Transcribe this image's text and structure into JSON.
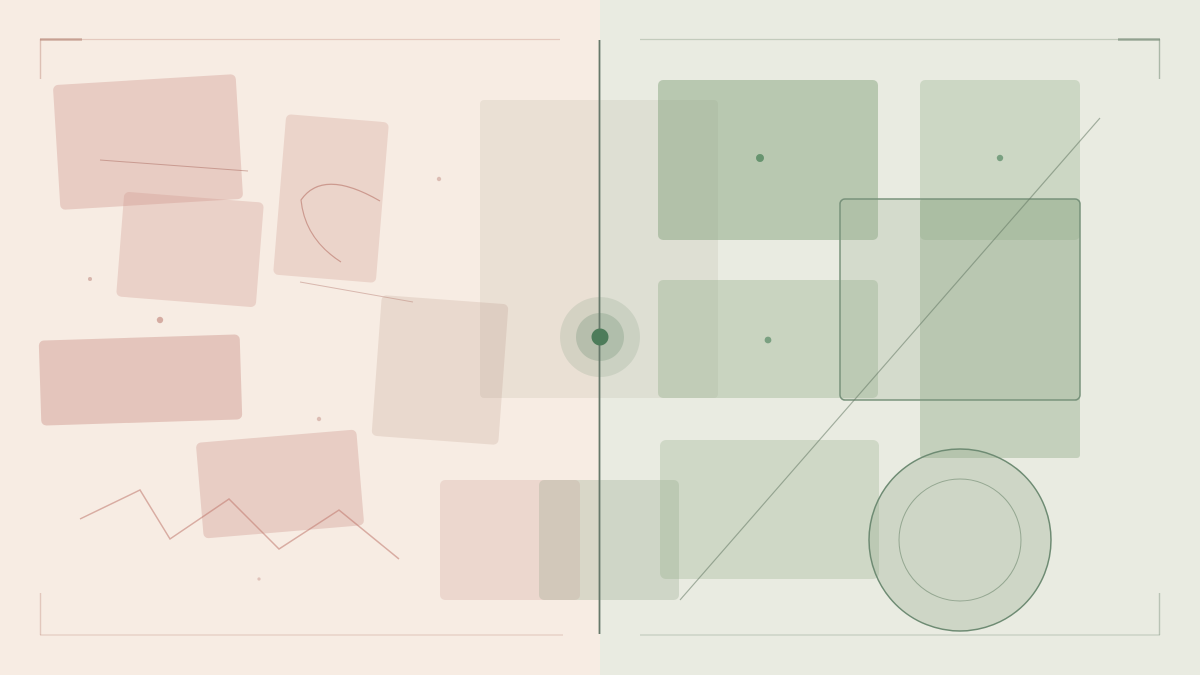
{
  "canvas": {
    "viewBox": "0 0 1200 675",
    "width": 1200,
    "height": 675,
    "split_x": 600,
    "left_background": "#f7ece3",
    "right_background": "#e9ebe1"
  },
  "palette": {
    "blush_fill": "rgba(206,148,138,0.36)",
    "blush_line": "rgba(170,105,95,0.5)",
    "sage_fill": "rgba(135,165,125,0.32)",
    "sage_outline": "#78927b",
    "divider": "#66786a",
    "bullseye_dot": "#4d7c5a"
  },
  "shapes": [
    {
      "type": "rect",
      "name": "background-left-panel",
      "x": 0,
      "y": 0,
      "w": 600,
      "h": 675,
      "fill": "#f7ece3"
    },
    {
      "type": "rect",
      "name": "background-right-panel",
      "x": 600,
      "y": 0,
      "w": 600,
      "h": 675,
      "fill": "#e9ebe1"
    },
    {
      "type": "rect",
      "name": "pink-rect-top-left",
      "x": 56.5,
      "y": 79.5,
      "w": 183,
      "h": 125,
      "rx": 5,
      "rot": -3.5,
      "fill": "rgba(206,148,138,0.36)"
    },
    {
      "type": "rect",
      "name": "pink-rect-mid-left",
      "x": 120,
      "y": 197,
      "w": 140,
      "h": 105,
      "rx": 5,
      "rot": 4.5,
      "fill": "rgba(208,152,142,0.32)"
    },
    {
      "type": "rect",
      "name": "pink-rect-arc-card",
      "x": 279.5,
      "y": 118,
      "w": 103,
      "h": 161,
      "rx": 5,
      "rot": 4.7,
      "fill": "rgba(208,155,145,0.30)"
    },
    {
      "type": "line",
      "name": "thin-line-upper",
      "x1": 100,
      "y1": 160,
      "x2": 248,
      "y2": 171,
      "stroke": "rgba(170,105,95,0.5)",
      "sw": 1
    },
    {
      "type": "path",
      "name": "arc-motif",
      "d": "M 380,201 Q 323,168 301,200 Q 305,239 341,262",
      "fill": "none",
      "stroke": "rgba(178,106,94,0.55)",
      "sw": 1.2
    },
    {
      "type": "line",
      "name": "thin-line-lower",
      "x1": 300,
      "y1": 282,
      "x2": 413,
      "y2": 302,
      "stroke": "rgba(170,105,95,0.4)",
      "sw": 1
    },
    {
      "type": "rect",
      "name": "pink-rect-wide-left",
      "x": 40,
      "y": 337.5,
      "w": 201,
      "h": 85,
      "rx": 5,
      "rot": -1.8,
      "fill": "rgba(200,140,130,0.40)"
    },
    {
      "type": "rect",
      "name": "pale-tilted-rect",
      "x": 376.5,
      "y": 299.5,
      "w": 127,
      "h": 141,
      "rx": 5,
      "rot": 4.2,
      "fill": "rgba(185,150,132,0.22)"
    },
    {
      "type": "rect",
      "name": "pink-rect-bottom",
      "x": 199.5,
      "y": 436,
      "w": 161,
      "h": 96,
      "rx": 5,
      "rot": -4.8,
      "fill": "rgba(203,148,138,0.34)"
    },
    {
      "type": "polyline",
      "name": "zigzag-line",
      "points": "80,519 140,490 170,539 229,499 279,549 339,510 399,559",
      "fill": "none",
      "stroke": "rgba(192,120,110,0.55)",
      "sw": 1.5
    },
    {
      "type": "circle",
      "name": "pink-dot-1",
      "cx": 90,
      "cy": 279,
      "r": 2,
      "fill": "rgba(175,115,105,0.45)"
    },
    {
      "type": "circle",
      "name": "pink-dot-2",
      "cx": 160,
      "cy": 320,
      "r": 3.2,
      "fill": "rgba(185,120,110,0.55)"
    },
    {
      "type": "circle",
      "name": "pink-dot-3",
      "cx": 439,
      "cy": 179,
      "r": 2.2,
      "fill": "rgba(180,120,110,0.4)"
    },
    {
      "type": "circle",
      "name": "pink-dot-4",
      "cx": 319,
      "cy": 419,
      "r": 2.2,
      "fill": "rgba(180,120,110,0.4)"
    },
    {
      "type": "circle",
      "name": "pink-dot-5",
      "cx": 259,
      "cy": 579,
      "r": 1.6,
      "fill": "rgba(180,120,110,0.35)"
    },
    {
      "type": "rect",
      "name": "pale-center-rect",
      "x": 480,
      "y": 100,
      "w": 238,
      "h": 298,
      "rx": 4,
      "fill": "rgba(125,115,92,0.10)"
    },
    {
      "type": "rect",
      "name": "straddle-pink-rect",
      "x": 440,
      "y": 480,
      "w": 140,
      "h": 120,
      "rx": 5,
      "fill": "rgba(208,160,150,0.28)"
    },
    {
      "type": "rect",
      "name": "straddle-green-rect",
      "x": 539,
      "y": 480,
      "w": 140,
      "h": 120,
      "rx": 5,
      "fill": "rgba(148,165,138,0.30)"
    },
    {
      "type": "rect",
      "name": "green-rect-top-left",
      "x": 658,
      "y": 80,
      "w": 220,
      "h": 160,
      "rx": 5,
      "fill": "rgba(125,158,118,0.45)"
    },
    {
      "type": "rect",
      "name": "green-rect-top-right",
      "x": 920,
      "y": 80,
      "w": 160,
      "h": 160,
      "rx": 5,
      "fill": "rgba(138,168,130,0.30)"
    },
    {
      "type": "rect",
      "name": "green-rect-tall",
      "x": 920,
      "y": 199,
      "w": 160,
      "h": 259,
      "rx": 3,
      "fill": "rgba(138,165,128,0.38)"
    },
    {
      "type": "rect",
      "name": "green-rect-middle",
      "x": 658,
      "y": 280,
      "w": 220,
      "h": 118,
      "rx": 5,
      "fill": "rgba(135,165,125,0.32)"
    },
    {
      "type": "rect",
      "name": "green-rect-bottom",
      "x": 660,
      "y": 440,
      "w": 219,
      "h": 139,
      "rx": 6,
      "fill": "rgba(140,168,130,0.28)"
    },
    {
      "type": "rect",
      "name": "outlined-green-rect",
      "x": 840,
      "y": 199,
      "w": 240,
      "h": 201,
      "rx": 5,
      "fill": "rgba(150,172,142,0.25)",
      "stroke": "#78927b",
      "sw": 1.5
    },
    {
      "type": "line",
      "name": "diagonal-line",
      "x1": 680,
      "y1": 600,
      "x2": 1100,
      "y2": 118,
      "stroke": "rgba(100,120,100,0.55)",
      "sw": 1.2
    },
    {
      "type": "circle",
      "name": "large-circle",
      "cx": 960,
      "cy": 540,
      "r": 91,
      "fill": "rgba(150,172,142,0.32)",
      "stroke": "#6e8b73",
      "sw": 1.5
    },
    {
      "type": "circle",
      "name": "large-circle-inner-ring",
      "cx": 960,
      "cy": 540,
      "r": 61,
      "fill": "none",
      "stroke": "rgba(110,135,110,0.6)",
      "sw": 1
    },
    {
      "type": "circle",
      "name": "green-dot-1",
      "cx": 760,
      "cy": 158,
      "r": 4,
      "fill": "#67946f"
    },
    {
      "type": "circle",
      "name": "green-dot-2",
      "cx": 1000,
      "cy": 158,
      "r": 3.2,
      "fill": "#7aa081"
    },
    {
      "type": "circle",
      "name": "green-dot-3",
      "cx": 768,
      "cy": 340,
      "r": 3.4,
      "fill": "#7aa081"
    },
    {
      "type": "circle",
      "name": "bullseye-outer-ring",
      "cx": 600,
      "cy": 337,
      "r": 40,
      "fill": "rgba(135,160,135,0.22)"
    },
    {
      "type": "circle",
      "name": "bullseye-mid-ring",
      "cx": 600,
      "cy": 337,
      "r": 24,
      "fill": "rgba(125,155,130,0.35)"
    },
    {
      "type": "line",
      "name": "center-divider-line",
      "x1": 599.5,
      "y1": 40,
      "x2": 599.5,
      "y2": 634,
      "stroke": "#66786a",
      "sw": 1.8
    },
    {
      "type": "circle",
      "name": "bullseye-center-dot",
      "cx": 600,
      "cy": 337,
      "r": 8.5,
      "fill": "#4d7c5a"
    },
    {
      "type": "line",
      "name": "frame-top-left-line",
      "x1": 40,
      "y1": 39.5,
      "x2": 560,
      "y2": 39.5,
      "stroke": "rgba(205,160,145,0.45)",
      "sw": 1.2
    },
    {
      "type": "line",
      "name": "frame-top-left-accent",
      "x1": 40,
      "y1": 39.5,
      "x2": 82,
      "y2": 39.5,
      "stroke": "rgba(175,125,110,0.55)",
      "sw": 2.4
    },
    {
      "type": "line",
      "name": "frame-top-left-arm",
      "x1": 40.5,
      "y1": 39,
      "x2": 40.5,
      "y2": 79,
      "stroke": "rgba(195,148,134,0.5)",
      "sw": 1.4
    },
    {
      "type": "line",
      "name": "frame-bottom-left-line",
      "x1": 40,
      "y1": 635,
      "x2": 563,
      "y2": 635,
      "stroke": "rgba(205,162,148,0.42)",
      "sw": 1.3
    },
    {
      "type": "line",
      "name": "frame-bottom-left-arm",
      "x1": 40.5,
      "y1": 593,
      "x2": 40.5,
      "y2": 635,
      "stroke": "rgba(200,155,140,0.45)",
      "sw": 1.4
    },
    {
      "type": "line",
      "name": "frame-top-right-line",
      "x1": 640,
      "y1": 39.5,
      "x2": 1160,
      "y2": 39.5,
      "stroke": "rgba(158,172,152,0.5)",
      "sw": 1.2
    },
    {
      "type": "line",
      "name": "frame-top-right-accent",
      "x1": 1118,
      "y1": 39.5,
      "x2": 1160,
      "y2": 39.5,
      "stroke": "rgba(118,138,118,0.65)",
      "sw": 2.4
    },
    {
      "type": "line",
      "name": "frame-top-right-arm",
      "x1": 1159.5,
      "y1": 39,
      "x2": 1159.5,
      "y2": 79,
      "stroke": "rgba(130,150,130,0.6)",
      "sw": 1.4
    },
    {
      "type": "line",
      "name": "frame-bottom-right-line",
      "x1": 640,
      "y1": 635,
      "x2": 1160,
      "y2": 635,
      "stroke": "rgba(162,176,158,0.5)",
      "sw": 1.3
    },
    {
      "type": "line",
      "name": "frame-bottom-right-arm",
      "x1": 1159.5,
      "y1": 593,
      "x2": 1159.5,
      "y2": 635,
      "stroke": "rgba(145,162,145,0.55)",
      "sw": 1.4
    }
  ]
}
